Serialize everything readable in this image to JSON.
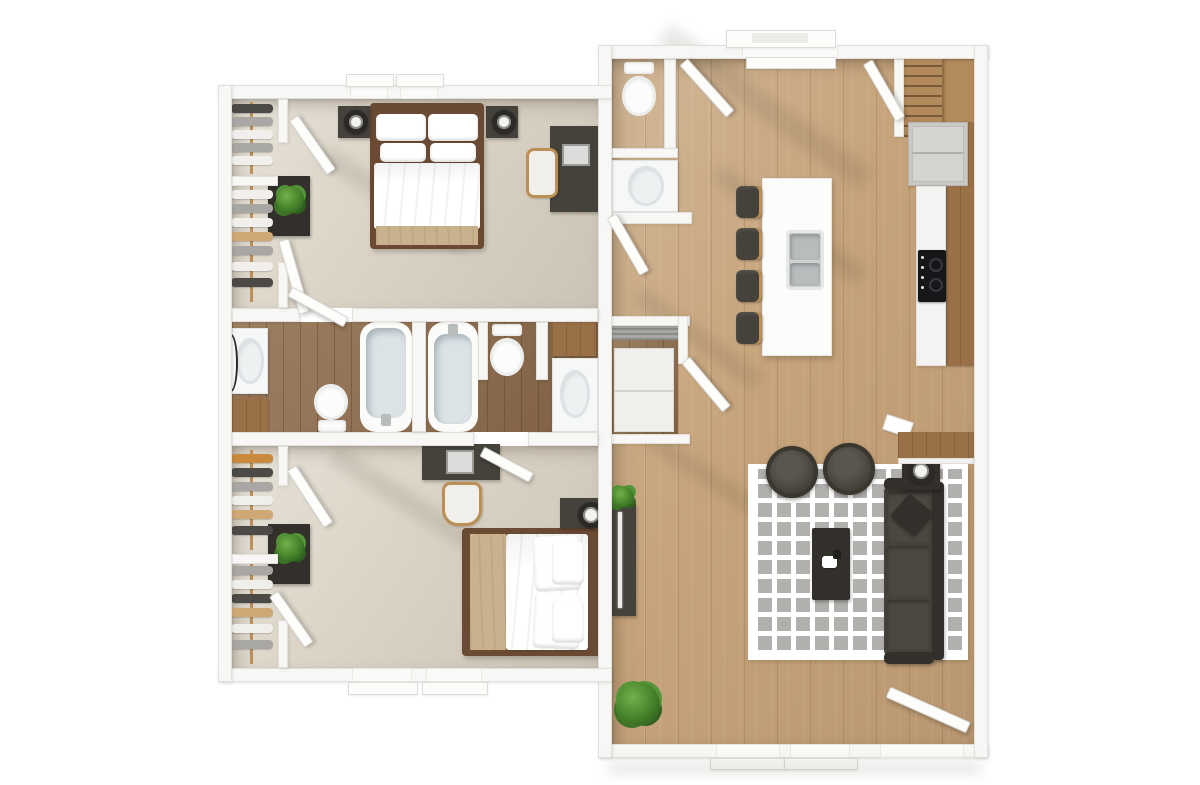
{
  "meta": {
    "description": "3D rendered top-down floor plan of a two-wing apartment",
    "canvas_width": 1200,
    "canvas_height": 785
  },
  "palette": {
    "background": "#ffffff",
    "wall": "#f8f7f5",
    "wall_edge": "#e1e0dc",
    "carpet": "#dcd5c7",
    "wood_floor": "#c6a37a",
    "wood_floor_dark": "#8e6a49",
    "cabinet_wood": "#9a7048",
    "furniture_dark": "#45413b",
    "furniture_darker": "#332f2b",
    "fixture_white": "#f6f7f7",
    "tub_inner": "#dce3e6",
    "bedding_tan": "#c9b18d",
    "bed_frame": "#6a4a33",
    "rug_square": "#b1b0ad",
    "appliance_gray": "#c9c8c5",
    "cooktop_black": "#17171a",
    "plant_green": "#4e9134",
    "wood_leg": "#bb8f55"
  },
  "left_unit": {
    "label": "Bedroom wing",
    "rooms": {
      "bedroom1": {
        "label": "Bedroom 1",
        "furniture": [
          "double bed with white and tan bedding",
          "two nightstands with lamps",
          "desk with laptop and chair",
          "walk-in closet with hanging clothes",
          "dresser with plant"
        ]
      },
      "bathroom1": {
        "label": "Bathroom 1",
        "furniture": [
          "vanity sink with mirror",
          "toilet",
          "bathtub"
        ]
      },
      "bathroom2": {
        "label": "Bathroom 2",
        "furniture": [
          "bathtub",
          "toilet",
          "vanity sink",
          "wood cabinet"
        ]
      },
      "bedroom2": {
        "label": "Bedroom 2",
        "furniture": [
          "double bed with white and tan bedding",
          "nightstand with lamp",
          "desk with laptop and chair",
          "walk-in closet with hanging clothes",
          "dresser with plant"
        ]
      }
    }
  },
  "right_unit": {
    "label": "Living wing",
    "rooms": {
      "powder": {
        "label": "Powder room",
        "furniture": [
          "toilet",
          "vanity sink"
        ]
      },
      "kitchen": {
        "label": "Kitchen",
        "furniture": [
          "white island with double sink",
          "four bar stools",
          "refrigerator",
          "black cooktop",
          "counter with wood top",
          "staircase"
        ]
      },
      "utility": {
        "label": "Utility closet",
        "furniture": [
          "white appliance"
        ]
      },
      "living": {
        "label": "Living room",
        "furniture": [
          "dark sofa with pillow",
          "two round armchairs",
          "coffee table",
          "gray checkered rug",
          "TV console",
          "side table with lamp",
          "potted plants"
        ]
      }
    }
  }
}
